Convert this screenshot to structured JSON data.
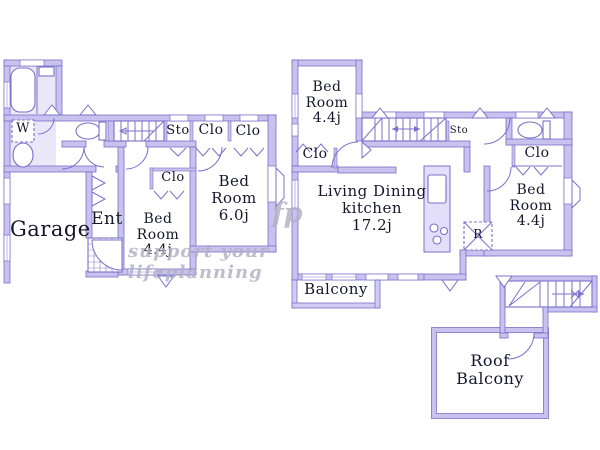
{
  "title": "House floor plan",
  "colors": {
    "wall_fill": "#c9c1ee",
    "wall_edge": "#7b70c9",
    "room_tint": "#eae7f9",
    "label_text": "#16162c",
    "watermark": "#b3b1c5",
    "background": "#ffffff"
  },
  "floor1": {
    "garage": "Garage",
    "entrance": "Ent",
    "washer": "W",
    "storage": "Sto",
    "closet_hall_1": "Clo",
    "closet_hall_2": "Clo",
    "bedroom_small": "Bed\nRoom\n4.4j",
    "bedroom_small_closet": "Clo",
    "bedroom_large": "Bed\nRoom\n6.0j"
  },
  "floor2": {
    "bedroom_north": "Bed\nRoom\n4.4j",
    "bedroom_north_closet": "Clo",
    "storage": "Sto",
    "living_dining_kitchen": "Living Dining\nkitchen\n17.2j",
    "refrigerator": "R",
    "bedroom_east_closet": "Clo",
    "bedroom_east": "Bed\nRoom\n4.4j",
    "balcony": "Balcony"
  },
  "floor3": {
    "roof_balcony": "Roof\nBalcony"
  },
  "watermark": {
    "logo": "fp",
    "tagline": "support your lifeplanning"
  }
}
